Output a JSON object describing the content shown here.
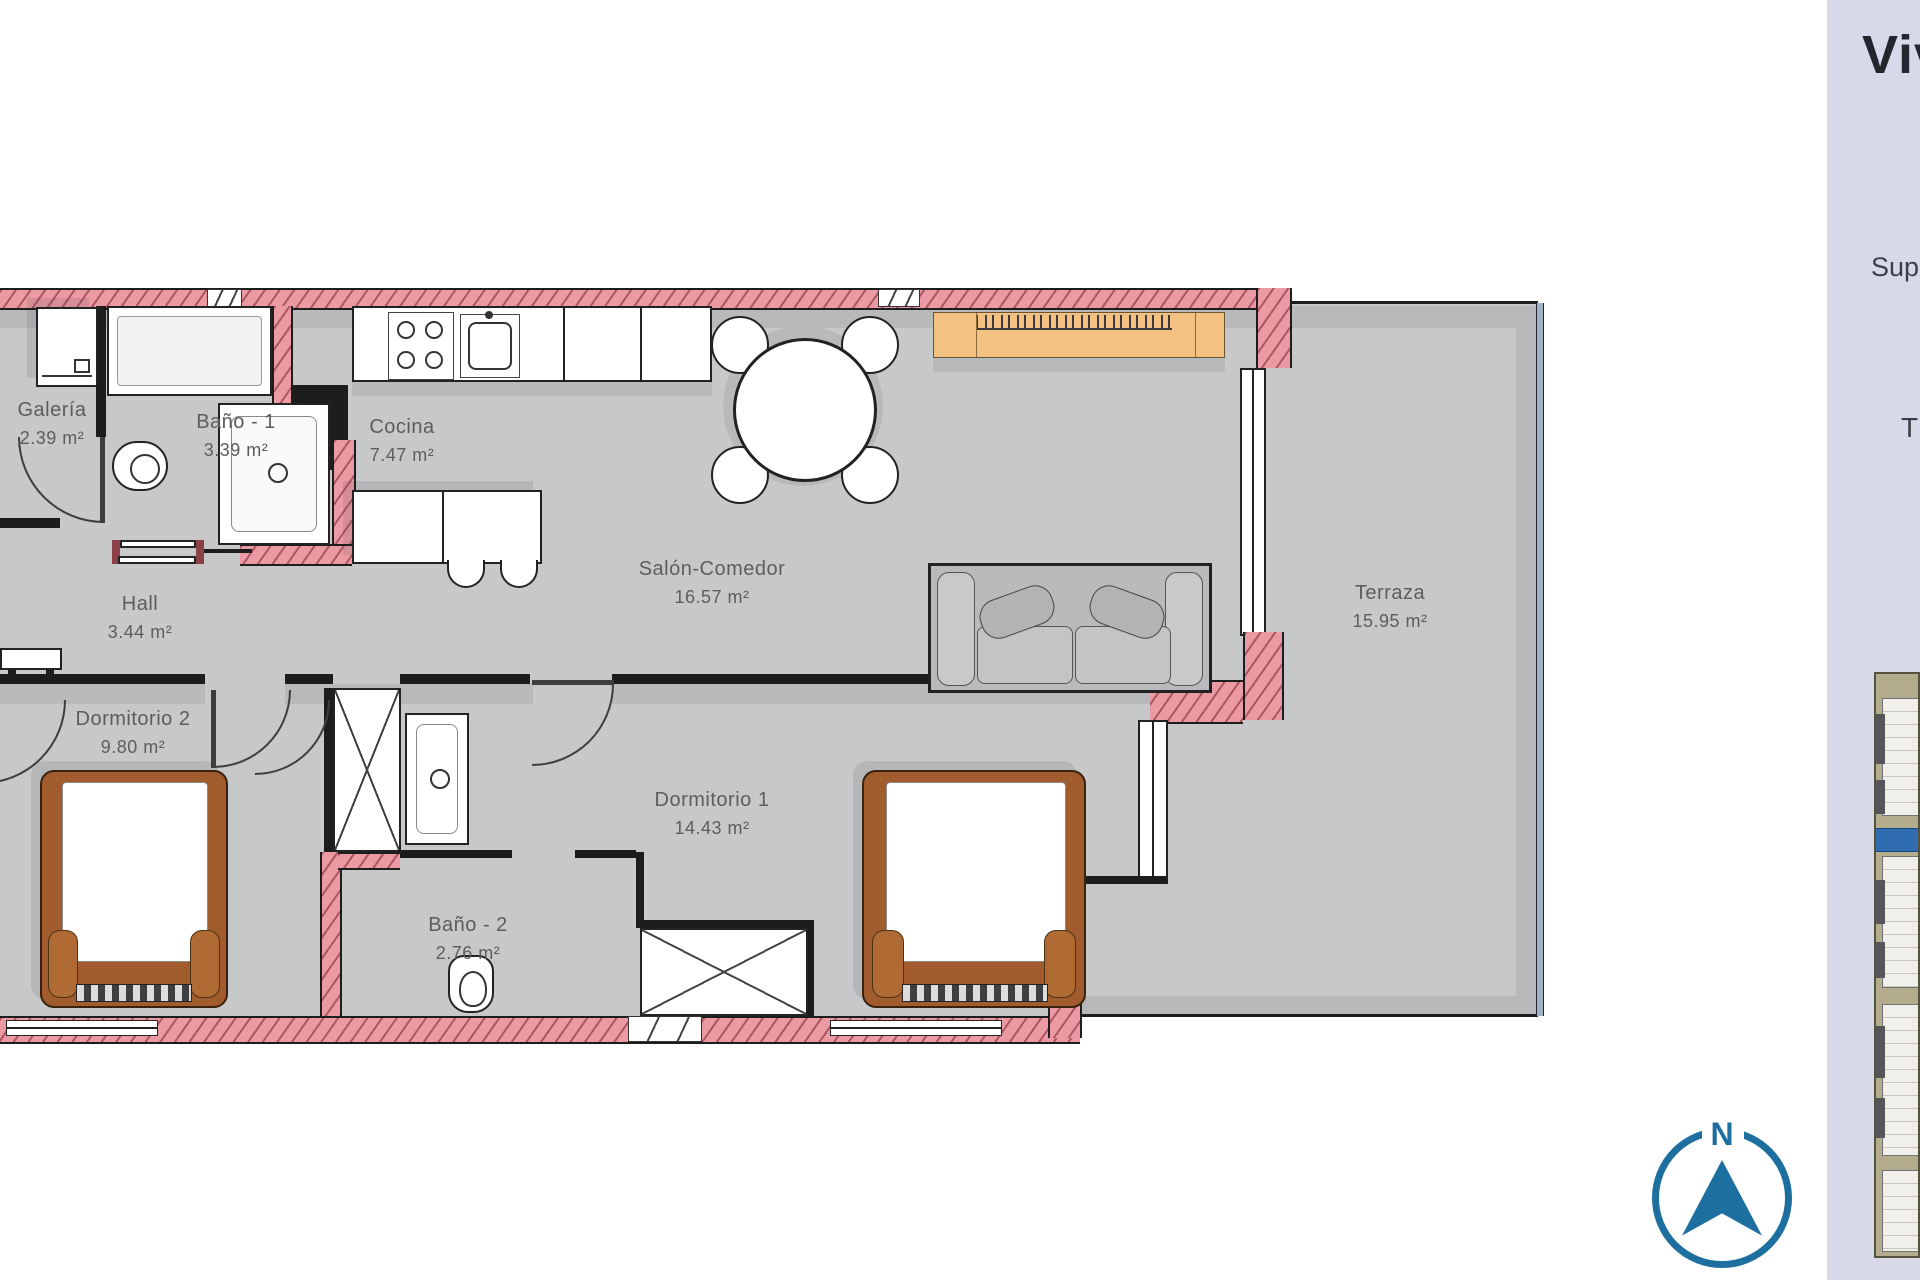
{
  "plan": {
    "rooms": [
      {
        "id": "galeria",
        "name": "Galería",
        "area": "2.39 m²"
      },
      {
        "id": "bano1",
        "name": "Baño - 1",
        "area": "3.39 m²"
      },
      {
        "id": "cocina",
        "name": "Cocina",
        "area": "7.47 m²"
      },
      {
        "id": "hall",
        "name": "Hall",
        "area": "3.44 m²"
      },
      {
        "id": "salon",
        "name": "Salón-Comedor",
        "area": "16.57 m²"
      },
      {
        "id": "dormitorio2",
        "name": "Dormitorio 2",
        "area": "9.80 m²"
      },
      {
        "id": "dormitorio1",
        "name": "Dormitorio 1",
        "area": "14.43 m²"
      },
      {
        "id": "bano2",
        "name": "Baño - 2",
        "area": "2.76 m²"
      },
      {
        "id": "terraza",
        "name": "Terraza",
        "area": "15.95 m²"
      }
    ]
  },
  "side_panel": {
    "title_partial": "Viv",
    "superficie_partial": "Sup",
    "terraza_partial": "T"
  },
  "compass": {
    "north_label": "N"
  },
  "colors": {
    "wall_pink": "#eb9aa3",
    "outline": "#1d1d1d",
    "floor": "#c7c8c9",
    "floor_shadow": "#b8b9bb",
    "accent_orange": "#f3c181",
    "bed_brown": "#a05c2c",
    "compass_blue": "#1d6f9f",
    "panel_lavender": "#d8d9e8",
    "map_highlight_blue": "#2f6db0",
    "railing_blue": "#9fb3c6"
  }
}
